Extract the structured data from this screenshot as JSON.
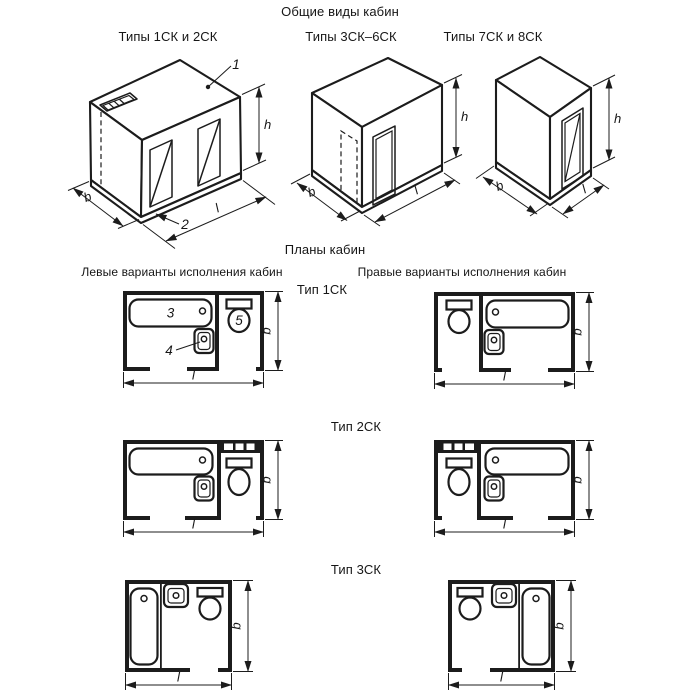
{
  "titles": {
    "general_views": "Общие виды кабин",
    "plans": "Планы кабин"
  },
  "view_headers": {
    "types_1_2": "Типы 1СК и 2СК",
    "types_3_6": "Типы 3СК–6СК",
    "types_7_8": "Типы 7СК и 8СК"
  },
  "plan_headers": {
    "left": "Левые варианты исполнения кабин",
    "right": "Правые варианты исполнения кабин"
  },
  "plan_types": {
    "t1": "Тип 1СК",
    "t2": "Тип 2СК",
    "t3": "Тип 3СК"
  },
  "dimensions": {
    "height": "h",
    "width": "b",
    "length": "l"
  },
  "callouts": {
    "roof_panel": "1",
    "floor_panel": "2",
    "bathtub": "3",
    "washbasin": "4",
    "toilet": "5"
  },
  "colors": {
    "line": "#1c1c1c",
    "background": "#ffffff"
  }
}
